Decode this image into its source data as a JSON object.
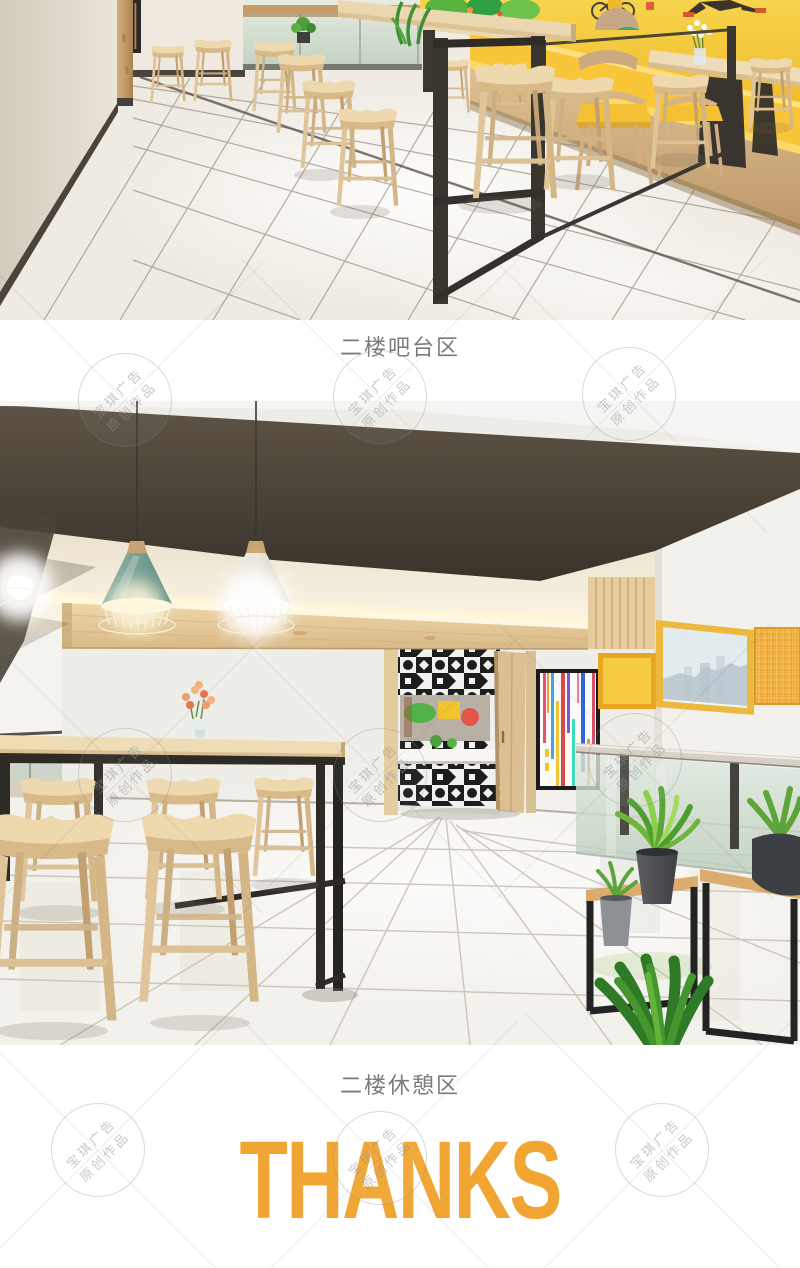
{
  "sections": {
    "photo1": {
      "name": "second-floor-bar-area-render",
      "caption": "二楼吧台区"
    },
    "photo2": {
      "name": "second-floor-lounge-area-render",
      "caption": "二楼休憩区"
    },
    "footer": {
      "thanks_label": "THANKS",
      "thanks_color": "#F1A633"
    }
  },
  "caption_color": "#7b7b7b",
  "watermark": {
    "line1": "宝琪广告",
    "line2": "原创作品"
  }
}
